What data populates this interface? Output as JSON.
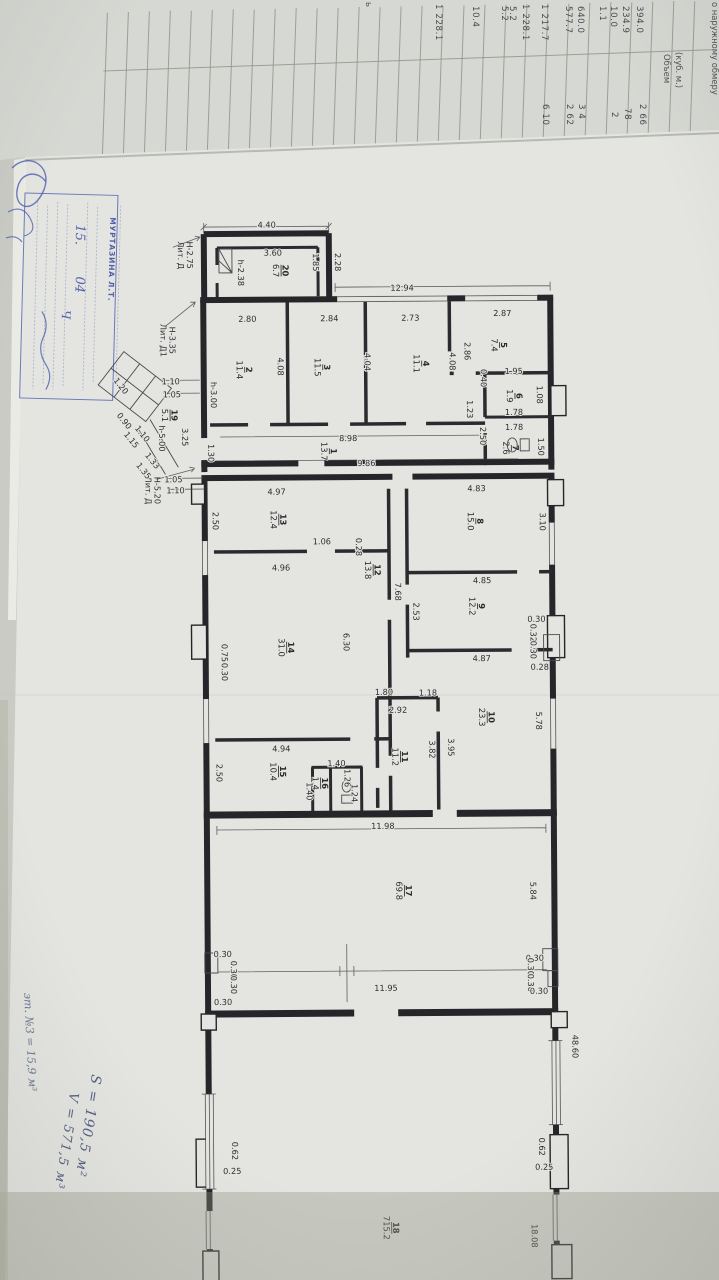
{
  "upper_table": {
    "partial_letter": "ь",
    "col2_header_title": "Объем",
    "col2_header_units": "(куб. м.)",
    "top_header_partial": "о наружному обмеру",
    "volumes": [
      "394.0",
      "234.9",
      "10.0",
      "1.1",
      "640.0",
      "577.7",
      "1 217.7",
      "1 228.1",
      "5.2",
      "5.2",
      "10.4",
      "1 228.1"
    ],
    "col2_partials": [
      "2 66",
      "78",
      "2",
      "3 4",
      "2 62",
      "6 10"
    ]
  },
  "stamp": {
    "name": "МУРТАЗИНА Л.Т.",
    "hand_day": "15.",
    "hand_month": "04",
    "hand_mark": "Ч"
  },
  "plan": {
    "lit_d_annex": {
      "name": "Лит. Д",
      "height": "Н-2.75"
    },
    "lit_d1": {
      "name": "Лит. Д1",
      "height": "Н-3.35"
    },
    "lit_d_main": {
      "name": "Лит. Д",
      "height": "Н-5.20"
    },
    "rooms": {
      "r1": {
        "num": "1",
        "area": "13.7"
      },
      "r2": {
        "num": "2",
        "area": "11.4"
      },
      "r3": {
        "num": "3",
        "area": "11.5"
      },
      "r4": {
        "num": "4",
        "area": "11.1"
      },
      "r5": {
        "num": "5",
        "area": "7.4"
      },
      "r6": {
        "num": "6",
        "area": "1.9"
      },
      "r7": {
        "num": "7",
        "area": "2.6"
      },
      "r8": {
        "num": "8",
        "area": "15.0"
      },
      "r9": {
        "num": "9",
        "area": "12.2"
      },
      "r10": {
        "num": "10",
        "area": "23.3"
      },
      "r11": {
        "num": "11",
        "area": "11.2"
      },
      "r12": {
        "num": "12",
        "area": "13.8"
      },
      "r13": {
        "num": "13",
        "area": "12.4"
      },
      "r14": {
        "num": "14",
        "area": "31.0"
      },
      "r15": {
        "num": "15",
        "area": "10.4"
      },
      "r16": {
        "num": "16",
        "area": "1.4"
      },
      "r17": {
        "num": "17",
        "area": "69.8"
      },
      "r18": {
        "num": "18",
        "area": "715.2"
      },
      "r19": {
        "num": "19",
        "area": "5.1"
      },
      "r20": {
        "num": "20",
        "area": "6.7"
      }
    },
    "dims": {
      "annex": [
        "4.40",
        "3.60",
        "1.85",
        "2.28",
        "h-2.38"
      ],
      "toprow": [
        "12.94",
        "2.80",
        "2.84",
        "2.73",
        "2.87",
        "4.08",
        "4.04",
        "4.08",
        "2.86",
        "h-3.00"
      ],
      "corr1": [
        "8.98",
        "9.86",
        "1.30",
        "3.25"
      ],
      "r67": [
        "1.95",
        "1.08",
        "1.78",
        "1.78",
        "2.50",
        "1.50",
        "0.40",
        "1.23"
      ],
      "stairs": [
        "1.10",
        "1.05",
        "1.20",
        "0.90",
        "1.15",
        "1.10",
        "1.33",
        "1.35",
        "h-5.00",
        "1.05",
        "1.10"
      ],
      "midleft": [
        "4.97",
        "2.50",
        "0.28",
        "1.06",
        "4.96",
        "6.30",
        "0.75",
        "0.30",
        "4.94",
        "2.50",
        "1.40",
        "1.26",
        "1.24",
        "1.40"
      ],
      "midright": [
        "4.83",
        "3.10",
        "4.85",
        "2.53",
        "4.87",
        "0.30",
        "0.32",
        "0.30",
        "0.28",
        "7.68",
        "1.80",
        "1.18",
        "2.92",
        "3.82",
        "3.95",
        "5.78"
      ],
      "r17z": [
        "11.98",
        "5.84",
        "11.95",
        "0.30",
        "0.30",
        "0.30",
        "0.30",
        "0.30",
        "0.30",
        "0.30",
        "0.30"
      ],
      "hall": [
        "48.60",
        "0.62",
        "0.25",
        "0.62",
        "0.25",
        "18.08"
      ]
    }
  },
  "notes": {
    "area_note": "S = 190,5 м²",
    "volume_note": "V = 571,5 м³",
    "margin_note": "эт. №3 = 15,9 м³"
  }
}
